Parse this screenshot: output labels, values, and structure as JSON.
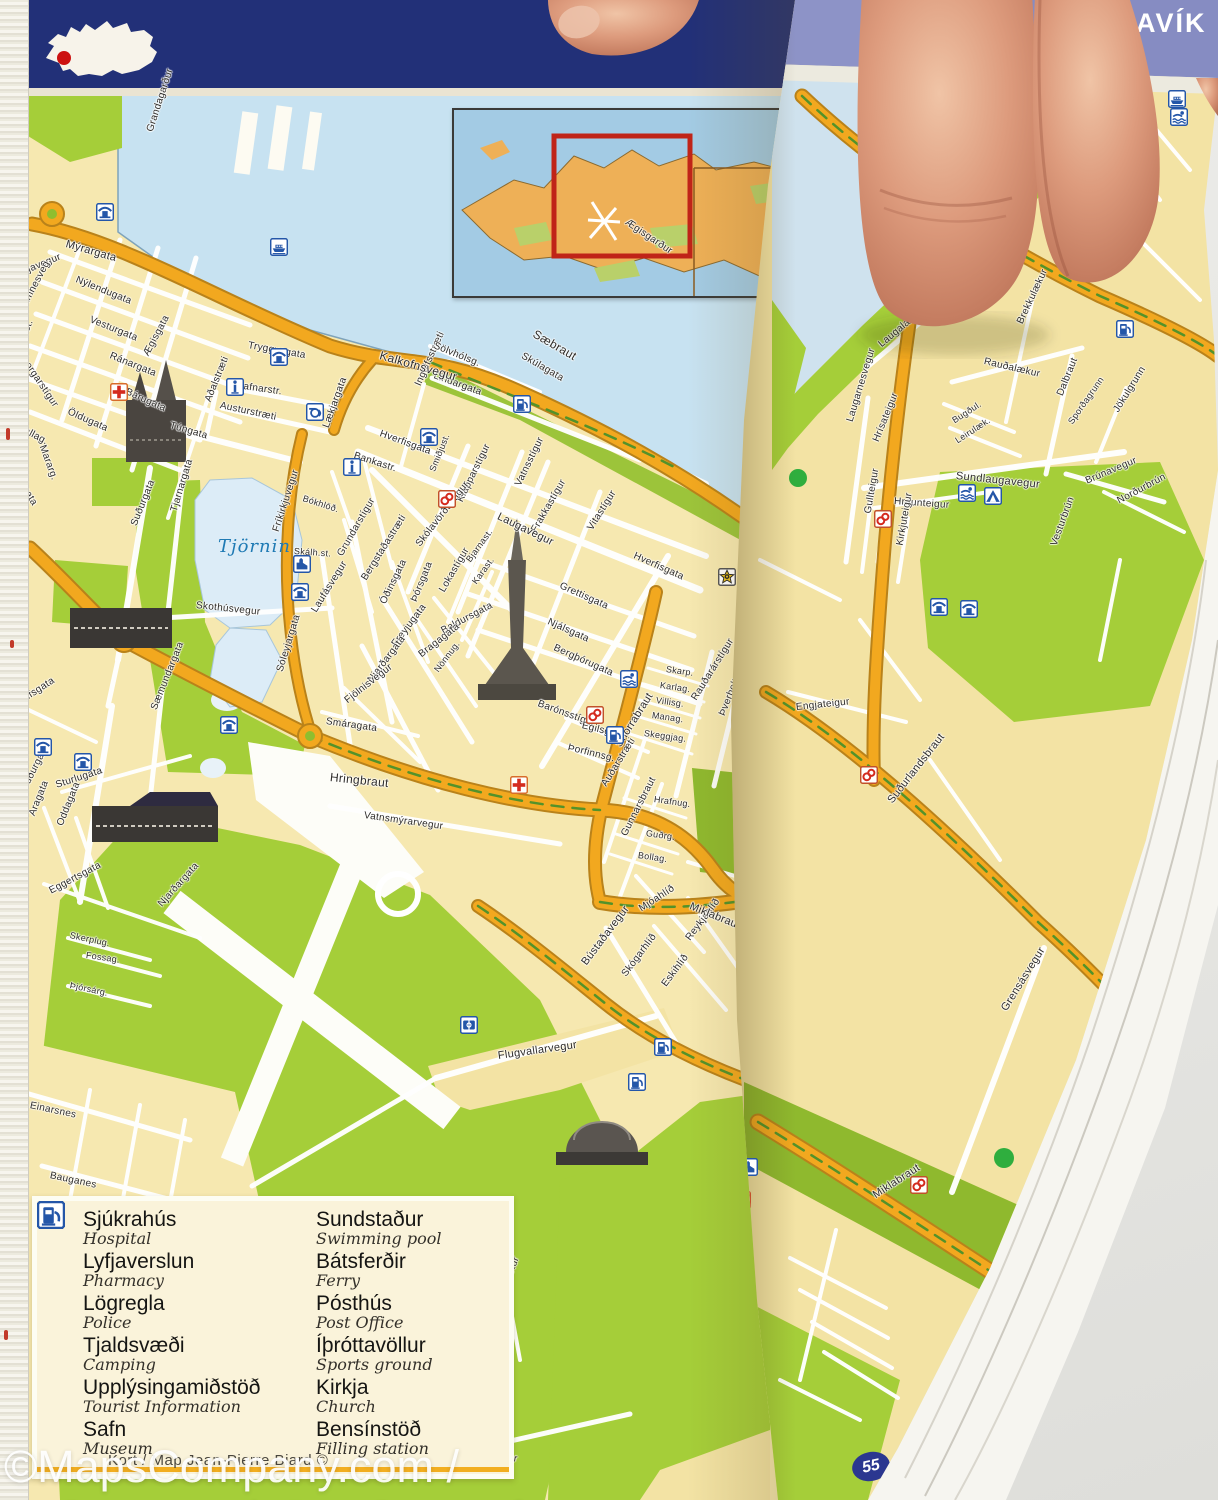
{
  "window": {
    "title_fragment": "AVÍK"
  },
  "map": {
    "lake_label": "Tjörnin",
    "page_number": "55",
    "watermark": "©MapsCompany.com / LaCompagnieDesCartes.fr",
    "credit": "Kort / Map Jean-Pierre Biard ©"
  },
  "colors": {
    "header_navy": "#223078",
    "header_periwinkle": "#8d93c7",
    "land_yellow": "#f6e8b0",
    "land_yellow_right": "#f3e3a4",
    "water_blue": "#c7e2f1",
    "lake_blue": "#dcecf7",
    "park_green": "#a5ce39",
    "road_orange": "#f2a81f",
    "street_white": "#ffffff",
    "icon_blue": "#2456a8",
    "hospital_red": "#d42a1e",
    "inset_land": "#eeb057",
    "inset_frame_red": "#c02418",
    "badge_navy": "#2b3790"
  },
  "legend": {
    "columns": [
      {
        "items": [
          {
            "is": "Sjúkrahús",
            "en": "Hospital",
            "icon": "hospital"
          },
          {
            "is": "Lyfjaverslun",
            "en": "Pharmacy",
            "icon": "pharmacy"
          },
          {
            "is": "Lögregla",
            "en": "Police",
            "icon": "police"
          },
          {
            "is": "Tjaldsvæði",
            "en": "Camping",
            "icon": "camping"
          },
          {
            "is": "Upplýsingamiðstöð",
            "en": "Tourist Information",
            "icon": "info"
          },
          {
            "is": "Safn",
            "en": "Museum",
            "icon": "museum"
          }
        ]
      },
      {
        "items": [
          {
            "is": "Sundstaður",
            "en": "Swimming pool",
            "icon": "pool"
          },
          {
            "is": "Bátsferðir",
            "en": "Ferry",
            "icon": "ferry"
          },
          {
            "is": "Pósthús",
            "en": "Post Office",
            "icon": "post"
          },
          {
            "is": "Íþróttavöllur",
            "en": "Sports ground",
            "icon": "sports"
          },
          {
            "is": "Kirkja",
            "en": "Church",
            "icon": "church"
          },
          {
            "is": "Bensínstöð",
            "en": "Filling station",
            "icon": "fuel"
          }
        ]
      }
    ]
  },
  "streets": [
    [
      "Grandagarður",
      150,
      126,
      -72,
      10,
      "L"
    ],
    [
      "Mýrargata",
      66,
      238,
      16,
      11,
      "L"
    ],
    [
      "Ægisgarður",
      626,
      216,
      34,
      10,
      "L"
    ],
    [
      "Seljavegur",
      14,
      270,
      -22,
      10,
      "L"
    ],
    [
      "Framnesveg.",
      20,
      308,
      -62,
      10,
      "L"
    ],
    [
      "Nýlendugata",
      76,
      274,
      22,
      10,
      "L"
    ],
    [
      "Vesturgata",
      90,
      314,
      22,
      10,
      "L"
    ],
    [
      "Ránargata",
      110,
      350,
      22,
      10,
      "L"
    ],
    [
      "Bárugata",
      126,
      386,
      24,
      10,
      "L"
    ],
    [
      "Ægisgata",
      146,
      350,
      -62,
      10,
      "L"
    ],
    [
      "Öldugata",
      68,
      406,
      24,
      10,
      "L"
    ],
    [
      "Mararg.",
      42,
      440,
      70,
      10,
      "L"
    ],
    [
      "Brekkust.",
      14,
      356,
      -68,
      10,
      "L"
    ],
    [
      "Bræðraborgarstígur",
      4,
      324,
      56,
      10,
      "L"
    ],
    [
      "Hávallag.",
      8,
      416,
      28,
      10,
      "L"
    ],
    [
      "Sólvallagata",
      4,
      450,
      58,
      10,
      "L"
    ],
    [
      "Túngata",
      170,
      420,
      16,
      10,
      "L"
    ],
    [
      "Tryggvagata",
      248,
      340,
      10,
      10,
      "L"
    ],
    [
      "Hafnarstr.",
      236,
      380,
      8,
      10,
      "L"
    ],
    [
      "Austurstræti",
      220,
      400,
      12,
      10,
      "L"
    ],
    [
      "Aðalstræti",
      208,
      396,
      -68,
      10,
      "L"
    ],
    [
      "Lækjargata",
      326,
      422,
      -70,
      10,
      "L"
    ],
    [
      "Bankastr.",
      354,
      450,
      18,
      10,
      "L"
    ],
    [
      "Hverfisgata",
      380,
      428,
      20,
      10,
      "L"
    ],
    [
      "Ingólfsstræti",
      418,
      380,
      -66,
      10,
      "L"
    ],
    [
      "Sölvhólsg.",
      434,
      340,
      22,
      10,
      "L"
    ],
    [
      "Lindargata",
      434,
      370,
      20,
      10,
      "L"
    ],
    [
      "Kalkofnsvegur",
      380,
      348,
      16,
      12,
      "L"
    ],
    [
      "Sæbraut",
      534,
      326,
      30,
      12,
      "L"
    ],
    [
      "Skúlagata",
      522,
      350,
      30,
      10,
      "L"
    ],
    [
      "Smiðjust.",
      432,
      466,
      -68,
      9,
      "L"
    ],
    [
      "Klapparstígur",
      460,
      496,
      -64,
      10,
      "L"
    ],
    [
      "Vatnsstígur",
      518,
      480,
      -64,
      10,
      "L"
    ],
    [
      "Frakkastígur",
      534,
      526,
      -60,
      10,
      "L"
    ],
    [
      "Laugavegur",
      498,
      510,
      26,
      11,
      "L"
    ],
    [
      "Skólavörðustígur",
      418,
      540,
      -52,
      10,
      "L"
    ],
    [
      "Hverfisgata",
      634,
      550,
      24,
      10,
      "L"
    ],
    [
      "Grettisgata",
      560,
      580,
      24,
      10,
      "L"
    ],
    [
      "Njálsgata",
      548,
      616,
      24,
      10,
      "L"
    ],
    [
      "Bergþórugata",
      554,
      642,
      24,
      10,
      "L"
    ],
    [
      "Vitastígur",
      590,
      524,
      -58,
      10,
      "L"
    ],
    [
      "Barónsstígur",
      538,
      698,
      20,
      10,
      "L"
    ],
    [
      "Bjarnast.",
      468,
      556,
      -54,
      9,
      "L"
    ],
    [
      "Karast.",
      474,
      578,
      -54,
      9,
      "L"
    ],
    [
      "Lokastígur",
      442,
      586,
      -60,
      10,
      "L"
    ],
    [
      "Þórsgata",
      414,
      596,
      -68,
      10,
      "L"
    ],
    [
      "Óðinsgata",
      383,
      598,
      -64,
      10,
      "L"
    ],
    [
      "Baldursgata",
      442,
      626,
      -28,
      10,
      "L"
    ],
    [
      "Bergstaðastræti",
      364,
      574,
      -58,
      10,
      "L"
    ],
    [
      "Grundarstígur",
      340,
      550,
      -60,
      10,
      "L"
    ],
    [
      "Laufásvegur",
      314,
      606,
      -58,
      10,
      "L"
    ],
    [
      "Fríkirkjuvegur",
      276,
      526,
      -72,
      10,
      "L"
    ],
    [
      "Skothúsvegur",
      196,
      600,
      6,
      10,
      "L"
    ],
    [
      "Tjarnargata",
      174,
      506,
      -73,
      10,
      "L"
    ],
    [
      "Suðurgata",
      134,
      520,
      -68,
      10,
      "L"
    ],
    [
      "Sóleyjargata",
      280,
      666,
      -73,
      10,
      "L"
    ],
    [
      "Freyjugata",
      394,
      640,
      -53,
      10,
      "L"
    ],
    [
      "Njarðargata",
      370,
      676,
      -53,
      10,
      "L"
    ],
    [
      "Fjölnisvegur",
      346,
      696,
      -38,
      10,
      "L"
    ],
    [
      "Smáragata",
      326,
      716,
      8,
      10,
      "L"
    ],
    [
      "Bragagata",
      420,
      650,
      -38,
      10,
      "L"
    ],
    [
      "Nönnug.",
      436,
      666,
      -53,
      9,
      "L"
    ],
    [
      "Hringbraut",
      330,
      770,
      6,
      12,
      "L"
    ],
    [
      "Vatnsmýrarvegur",
      364,
      810,
      8,
      10,
      "L"
    ],
    [
      "Hringbraut",
      2,
      538,
      -78,
      11,
      "L"
    ],
    [
      "Brynjólfsgata",
      2,
      708,
      -33,
      10,
      "L"
    ],
    [
      "Suðurgata",
      24,
      784,
      -63,
      10,
      "L"
    ],
    [
      "Sturlugata",
      56,
      780,
      -18,
      10,
      "L"
    ],
    [
      "Aragata",
      32,
      810,
      -68,
      10,
      "L"
    ],
    [
      "Oddagata",
      60,
      820,
      -68,
      10,
      "L"
    ],
    [
      "Eggertsgata",
      50,
      886,
      -28,
      10,
      "L"
    ],
    [
      "Sæmundargata",
      154,
      704,
      -68,
      10,
      "L"
    ],
    [
      "Njarðargata",
      160,
      900,
      -48,
      10,
      "L"
    ],
    [
      "Skerplug.",
      70,
      930,
      12,
      9,
      "L"
    ],
    [
      "Fossag.",
      86,
      950,
      8,
      9,
      "L"
    ],
    [
      "Þjórsárg.",
      70,
      980,
      12,
      9,
      "L"
    ],
    [
      "Einarsnes",
      30,
      1100,
      12,
      10,
      "L"
    ],
    [
      "Bauganes",
      50,
      1170,
      12,
      10,
      "L"
    ],
    [
      "Nauthólsvegur",
      450,
      1442,
      10,
      10,
      "L"
    ],
    [
      "Flugvallarvegur",
      498,
      1050,
      -8,
      11,
      "L"
    ],
    [
      "Bústaðavegur",
      584,
      958,
      -53,
      11,
      "L"
    ],
    [
      "Skógarhlíð",
      624,
      970,
      -53,
      10,
      "L"
    ],
    [
      "Mjóahlíð",
      640,
      904,
      -33,
      10,
      "L"
    ],
    [
      "Eskihlíð",
      664,
      980,
      -53,
      10,
      "L"
    ],
    [
      "Reykjahlíð",
      688,
      934,
      -53,
      10,
      "L"
    ],
    [
      "Miklabraut",
      690,
      900,
      22,
      11,
      "L"
    ],
    [
      "Snorrabraut",
      618,
      740,
      -58,
      11,
      "L"
    ],
    [
      "Auðarstræti",
      604,
      780,
      -58,
      10,
      "L"
    ],
    [
      "Rauðarárstígur",
      694,
      694,
      -58,
      10,
      "L"
    ],
    [
      "Þverholt",
      722,
      710,
      -68,
      10,
      "L"
    ],
    [
      "Skarp.",
      666,
      664,
      8,
      9,
      "L"
    ],
    [
      "Karlag.",
      660,
      680,
      8,
      9,
      "L"
    ],
    [
      "Villisg.",
      656,
      695,
      8,
      9,
      "L"
    ],
    [
      "Manag.",
      652,
      710,
      8,
      9,
      "L"
    ],
    [
      "Skeggjag.",
      644,
      728,
      8,
      9,
      "L"
    ],
    [
      "Gunnarsbraut",
      624,
      830,
      -63,
      10,
      "L"
    ],
    [
      "Hrafnug.",
      654,
      794,
      8,
      9,
      "L"
    ],
    [
      "Guðrg.",
      646,
      828,
      8,
      9,
      "L"
    ],
    [
      "Bollag.",
      638,
      850,
      8,
      9,
      "L"
    ],
    [
      "Egilsgata",
      582,
      720,
      14,
      10,
      "L"
    ],
    [
      "Þorfinnsg.",
      568,
      742,
      14,
      10,
      "L"
    ],
    [
      "Hlíðarfótur",
      498,
      1298,
      -68,
      10,
      "L"
    ],
    [
      "Bókhlöð.",
      303,
      493,
      18,
      9,
      "L"
    ],
    [
      "Skálh.st.",
      294,
      546,
      4,
      9,
      "L"
    ],
    [
      "Laugalækur",
      880,
      340,
      -40,
      10,
      "R"
    ],
    [
      "Laugarnesvegur",
      850,
      416,
      -73,
      10,
      "R"
    ],
    [
      "Hrísateigur",
      876,
      436,
      -68,
      10,
      "R"
    ],
    [
      "Rauðalækur",
      984,
      356,
      13,
      10,
      "R"
    ],
    [
      "Brekkulækur",
      1020,
      318,
      -65,
      10,
      "R"
    ],
    [
      "Bugðul.",
      953,
      416,
      -33,
      9,
      "R"
    ],
    [
      "Leirulæk.",
      956,
      436,
      -33,
      9,
      "R"
    ],
    [
      "Dalbraut",
      1060,
      390,
      -68,
      10,
      "R"
    ],
    [
      "Sporðagrunn",
      1070,
      418,
      -55,
      9,
      "R"
    ],
    [
      "Jökulgrunn",
      1116,
      406,
      -58,
      10,
      "R"
    ],
    [
      "Sundlaugavegur",
      956,
      470,
      6,
      11,
      "R"
    ],
    [
      "Brúnavegur",
      1086,
      476,
      -23,
      10,
      "R"
    ],
    [
      "Hraunteigur",
      894,
      496,
      4,
      10,
      "R"
    ],
    [
      "Gullteigur",
      868,
      508,
      -80,
      10,
      "R"
    ],
    [
      "Kirkjuteigur",
      900,
      540,
      -80,
      10,
      "R"
    ],
    [
      "Vesturbrún",
      1054,
      540,
      -70,
      10,
      "R"
    ],
    [
      "Norðurbrún",
      1118,
      496,
      -28,
      10,
      "R"
    ],
    [
      "Suðurlandsbraut",
      890,
      796,
      -52,
      11,
      "R"
    ],
    [
      "Grensásvegur",
      1004,
      1004,
      -58,
      11,
      "R"
    ],
    [
      "Miklabraut",
      874,
      1190,
      -33,
      11,
      "R"
    ],
    [
      "Engjateigur",
      796,
      702,
      -6,
      10,
      "R"
    ]
  ],
  "icons": [
    [
      "info",
      10,
      212,
      "L"
    ],
    [
      "museum",
      96,
      203,
      "L"
    ],
    [
      "ferry",
      270,
      238,
      "L"
    ],
    [
      "museum",
      270,
      348,
      "L"
    ],
    [
      "info",
      226,
      378,
      "L"
    ],
    [
      "post",
      306,
      403,
      "L"
    ],
    [
      "museum",
      420,
      428,
      "L"
    ],
    [
      "info",
      343,
      458,
      "L"
    ],
    [
      "fuel",
      513,
      395,
      "L"
    ],
    [
      "pharmacy",
      438,
      490,
      "L"
    ],
    [
      "church",
      293,
      555,
      "L"
    ],
    [
      "museum",
      291,
      583,
      "L"
    ],
    [
      "police",
      718,
      568,
      "L"
    ],
    [
      "pool",
      620,
      670,
      "L"
    ],
    [
      "pharmacy",
      586,
      706,
      "L"
    ],
    [
      "fuel",
      606,
      726,
      "L"
    ],
    [
      "museum",
      220,
      716,
      "L"
    ],
    [
      "museum",
      34,
      738,
      "L"
    ],
    [
      "museum",
      74,
      753,
      "L"
    ],
    [
      "hospital",
      510,
      776,
      "L"
    ],
    [
      "sports",
      460,
      1016,
      "L"
    ],
    [
      "fuel",
      654,
      1038,
      "L"
    ],
    [
      "fuel",
      628,
      1073,
      "L"
    ],
    [
      "hospital",
      110,
      383,
      "L"
    ],
    [
      "ferry",
      1168,
      90,
      "R"
    ],
    [
      "pool",
      1170,
      108,
      "R"
    ],
    [
      "fuel",
      1116,
      320,
      "R"
    ],
    [
      "pool",
      958,
      484,
      "R"
    ],
    [
      "camping",
      984,
      487,
      "R"
    ],
    [
      "pharmacy",
      874,
      510,
      "R"
    ],
    [
      "pharmacy",
      860,
      766,
      "R"
    ],
    [
      "pharmacy",
      910,
      1176,
      "R"
    ],
    [
      "church",
      740,
      1158,
      "R"
    ],
    [
      "info",
      720,
      1288,
      "R"
    ],
    [
      "pharmacy",
      733,
      1191,
      "R"
    ],
    [
      "museum",
      930,
      598,
      "R"
    ],
    [
      "museum",
      960,
      600,
      "R"
    ]
  ]
}
